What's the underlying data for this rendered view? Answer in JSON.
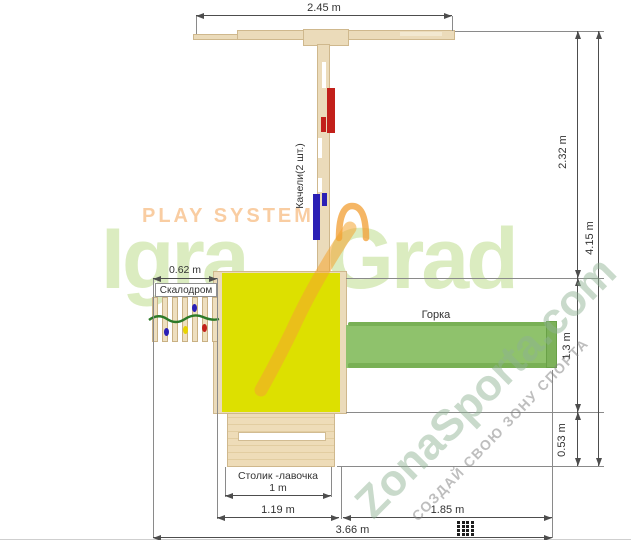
{
  "watermarks": {
    "play_system": "PLAY SYSTEM",
    "logo_igra": "Igra",
    "logo_grad": "Grad",
    "site": "ZonaSporta.com",
    "slogan": "СОЗДАЙ СВОЮ ЗОНУ СПОРТА"
  },
  "labels": {
    "swings": "Качели(2 шт.)",
    "climbing_wall": "Скалодром",
    "slide": "Горка",
    "table_bench": "Столик -лавочка"
  },
  "dims": {
    "beam_span": "2.45 m",
    "upper_height": "2.32 m",
    "total_height": "4.15 m",
    "platform_depth": "1.3 m",
    "bench_depth": "0.53 m",
    "climb_width": "0.62 m",
    "table_width": "1 m",
    "left_span": "1.19 m",
    "slide_span": "1.85 m",
    "total_width": "3.66 m"
  },
  "colors": {
    "platform_yellow": "#dde000",
    "slide_green": "#8fc26c",
    "wood": "#ebdbba",
    "swing_red": "#c2201a",
    "swing_blue": "#2a1fb5",
    "logo_green": "#dbecc0",
    "logo_orange": "#f4a335",
    "dim_line": "#4d4d4d"
  }
}
